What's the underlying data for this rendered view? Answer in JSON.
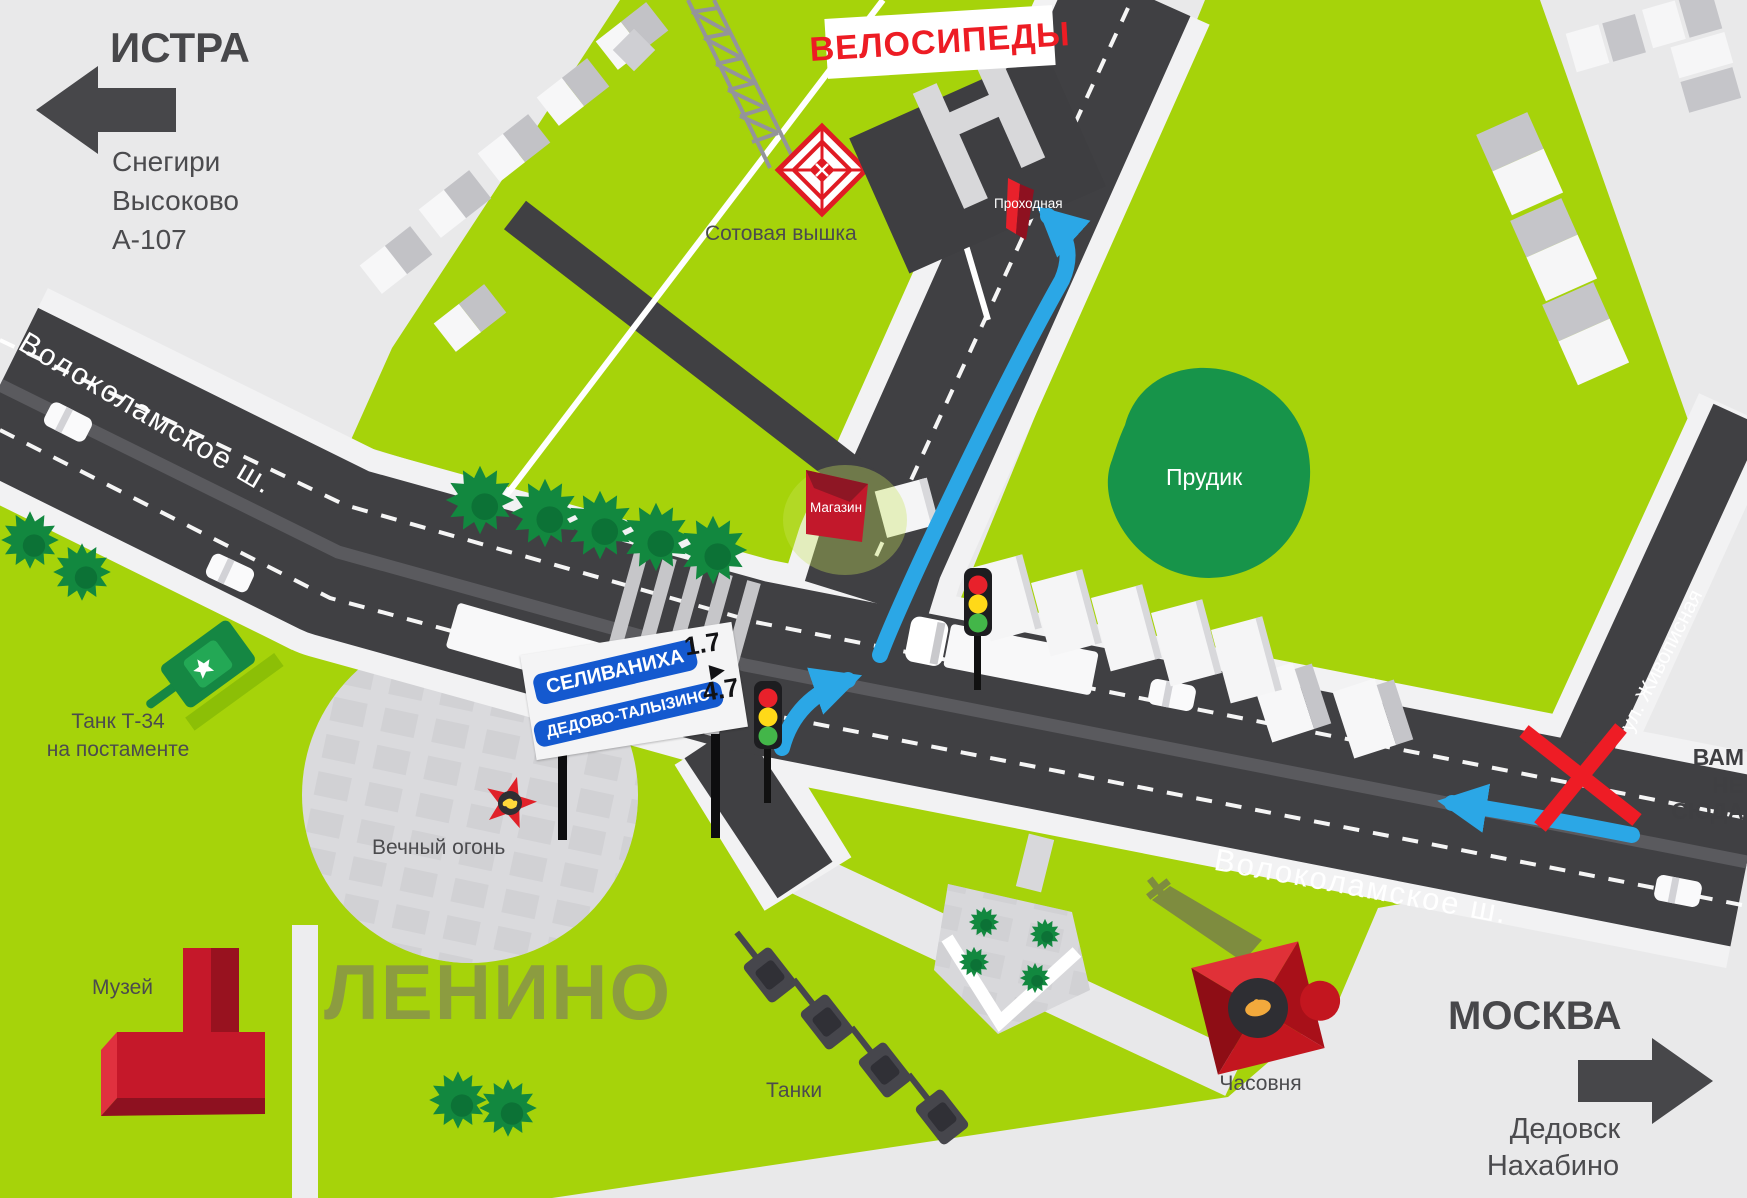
{
  "directions": {
    "istra": {
      "label": "ИСТРА",
      "towns": [
        "Снегири",
        "Высоково",
        "А-107"
      ]
    },
    "moscow": {
      "label": "МОСКВА",
      "towns": [
        "Дедовск",
        "Нахабино"
      ]
    }
  },
  "destination": {
    "label": "ВЕЛОСИПЕДЫ"
  },
  "roads": {
    "volokolamskoe_west": "Волоколамское ш.",
    "volokolamskoe_east": "Волоколамское ш.",
    "zhivopisnaya": "ул. Живописная"
  },
  "sign": {
    "items": [
      {
        "name": "СЕЛИВАНИХА",
        "distance": "1.7"
      },
      {
        "name": "ДЕДОВО-ТАЛЫЗИНО",
        "distance": "4.7"
      }
    ],
    "arrow": "▶"
  },
  "landmarks": {
    "cell_tower": "Сотовая вышка",
    "checkpoint": "Проходная",
    "shop": "Магазин",
    "pond": "Прудик",
    "tank_line1": "Танк Т-34",
    "tank_line2": "на постаменте",
    "eternal_flame": "Вечный огонь",
    "museum": "Музей",
    "town": "ЛЕНИНО",
    "tanks_row": "Танки",
    "chapel": "Часовня"
  },
  "warning": {
    "line1": "ВАМ",
    "line2": "НЕ СЮДА"
  },
  "icons": {
    "west_arrow": "left-direction-arrow",
    "east_arrow": "right-direction-arrow",
    "wrong_way_cross": "red-x",
    "route_arrows": "blue-route-arrows",
    "traffic_lights": "traffic-light",
    "cell_tower_target": "red-diamond-target"
  },
  "colors": {
    "background": "#e9e9ea",
    "grass": "#a6d30a",
    "road": "#404043",
    "sidewalk": "#f2f2f3",
    "route_blue": "#2ba7e6",
    "accent_red": "#e8212b",
    "sign_blue": "#1459cf",
    "town_text": "#8c9c40",
    "dark_text": "#4b4b4e",
    "pond_green": "#17944a"
  }
}
